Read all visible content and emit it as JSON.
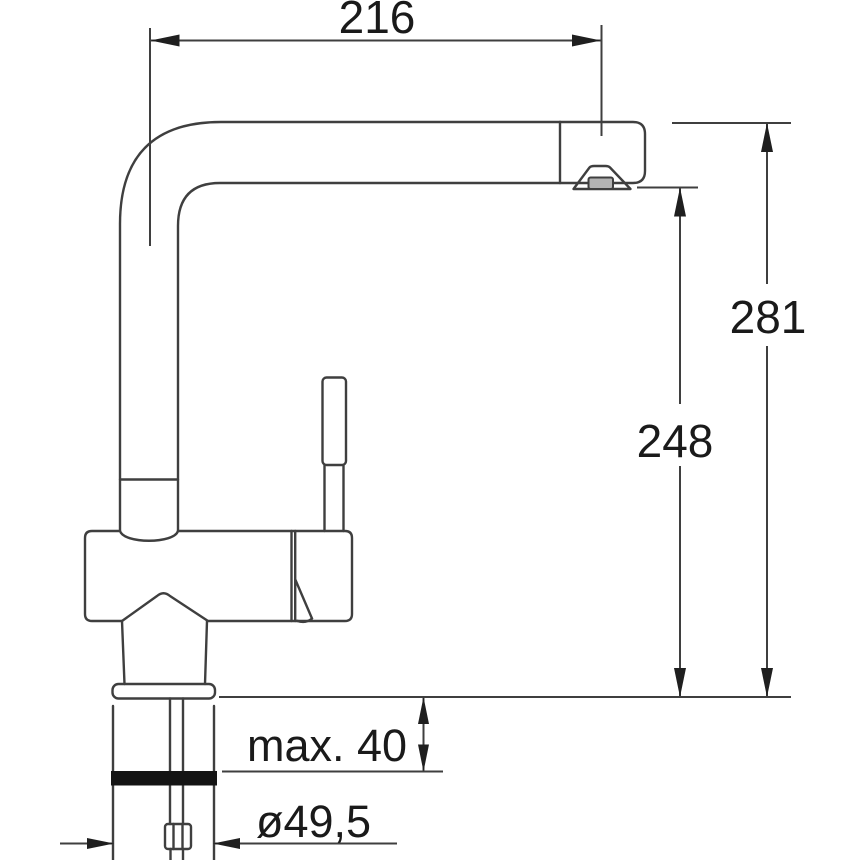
{
  "dimensions": {
    "spout_reach": "216",
    "overall_height": "281",
    "outlet_height": "248",
    "mount_thickness": "max. 40",
    "hole_diameter": "ø49,5"
  },
  "colors": {
    "line": "#3f3f3f",
    "text": "#1a1a1a",
    "arrow": "#1f1f1f",
    "seal_band": "#141414",
    "aerator_fill": "#b3b3b3",
    "background": "#ffffff"
  }
}
